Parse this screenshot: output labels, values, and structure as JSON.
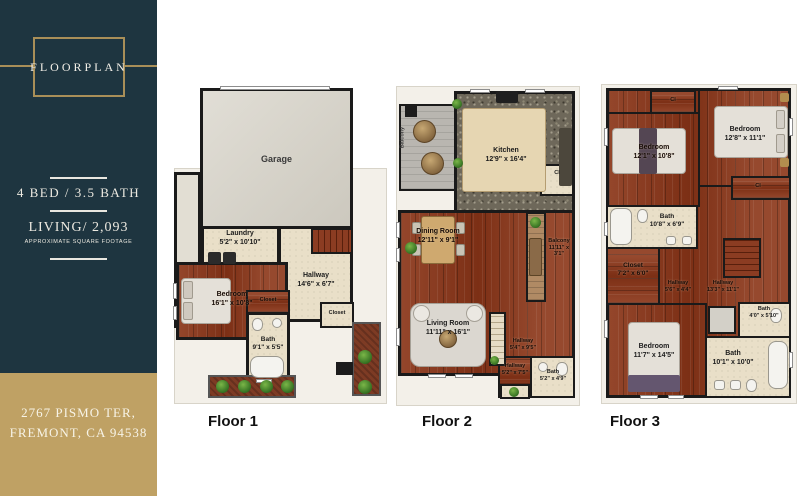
{
  "sidebar": {
    "logo": "FLOORPLAN",
    "bed_bath": "4 BED / 3.5 BATH",
    "living": "LIVING/ 2,093",
    "living_sub": "APPROXIMATE SQUARE FOOTAGE",
    "address1": "2767 PISMO TER,",
    "address2": "FREMONT, CA 94538"
  },
  "colors": {
    "sidebar_bg": "#1e3540",
    "gold_accent": "#a98f58",
    "address_bg": "#bfa164",
    "wood_floor": "#8b3c22",
    "tile_floor": "#e9dfc8",
    "wall": "#1a1a1a"
  },
  "floors": [
    {
      "label": "Floor 1",
      "rooms": {
        "garage": {
          "name": "Garage",
          "dims": ""
        },
        "laundry": {
          "name": "Laundry",
          "dims": "5'2\" x 10'10\""
        },
        "hallway": {
          "name": "Hallway",
          "dims": "14'6\" x 6'7\""
        },
        "bedroom": {
          "name": "Bedroom",
          "dims": "16'1\" x 10'8\""
        },
        "closet1": {
          "name": "Closet"
        },
        "closet2": {
          "name": "Closet"
        },
        "bath": {
          "name": "Bath",
          "dims": "9'1\" x 5'5\""
        }
      }
    },
    {
      "label": "Floor 2",
      "rooms": {
        "kitchen": {
          "name": "Kitchen",
          "dims": "12'9\" x 16'4\""
        },
        "closet": {
          "name": "Cl"
        },
        "dining": {
          "name": "Dining Room",
          "dims": "12'11\" x 9'1\""
        },
        "living": {
          "name": "Living Room",
          "dims": "11'11\" x 16'1\""
        },
        "balcony_left": {
          "name": "Balcony"
        },
        "balcony_right": {
          "name": "Balcony",
          "dims": "11'11\" x 3'1\""
        },
        "hallway1": {
          "name": "Hallway",
          "dims": "5'4\" x 9'5\""
        },
        "hallway2": {
          "name": "Hallway",
          "dims": "5'2\" x 7'5\""
        },
        "bath": {
          "name": "Bath",
          "dims": "5'2\" x 4'9\""
        }
      }
    },
    {
      "label": "Floor 3",
      "rooms": {
        "closet_top": {
          "name": "Cl"
        },
        "bedroom_left": {
          "name": "Bedroom",
          "dims": "12'1\" x 10'8\""
        },
        "bedroom_right": {
          "name": "Bedroom",
          "dims": "12'8\" x 11'1\""
        },
        "closet_right": {
          "name": "Cl"
        },
        "bath_top": {
          "name": "Bath",
          "dims": "10'8\" x 6'9\""
        },
        "closet": {
          "name": "Closet",
          "dims": "7'2\" x 6'0\""
        },
        "hallway_small": {
          "name": "Hallway",
          "dims": "5'6\" x 4'4\""
        },
        "hallway_large": {
          "name": "Hallway",
          "dims": "13'3\" x 11'1\""
        },
        "bath_small": {
          "name": "Bath",
          "dims": "4'0\" x 5'10\""
        },
        "bedroom_bottom": {
          "name": "Bedroom",
          "dims": "11'7\" x 14'5\""
        },
        "bath_bottom": {
          "name": "Bath",
          "dims": "10'1\" x 10'0\""
        }
      }
    }
  ]
}
